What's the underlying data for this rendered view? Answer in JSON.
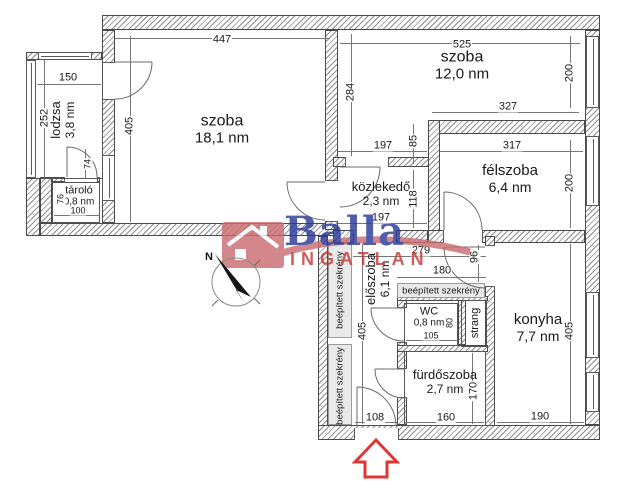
{
  "logo": {
    "brand": "Balla",
    "sub": "INGATLAN"
  },
  "compass": {
    "label": "N"
  },
  "colors": {
    "logo_blue": "#2b3a98",
    "logo_red": "#c13b38",
    "logo_house": "#ca6d71",
    "arrow_red": "#e03535",
    "wall_hatch": "#8f8f8f"
  },
  "rooms": [
    {
      "id": "lodzsa",
      "name": "lodzsa",
      "area": "3,8 nm",
      "x": 63,
      "y": 120,
      "vertical": true,
      "size": 13
    },
    {
      "id": "szoba-1",
      "name": "szoba",
      "area": "18,1 nm",
      "x": 222,
      "y": 130,
      "vertical": false,
      "size": 16
    },
    {
      "id": "szoba-2",
      "name": "szoba",
      "area": "12,0 nm",
      "x": 462,
      "y": 66,
      "vertical": false,
      "size": 16
    },
    {
      "id": "felszoba",
      "name": "félszoba",
      "area": "6,4 nm",
      "x": 510,
      "y": 179,
      "vertical": false,
      "size": 15
    },
    {
      "id": "kozlekedo",
      "name": "közlekedő",
      "area": "2,3 nm",
      "x": 381,
      "y": 194,
      "vertical": false,
      "size": 13
    },
    {
      "id": "tarolo",
      "name": "tároló",
      "area": "0,8 nm",
      "x": 79,
      "y": 196,
      "vertical": false,
      "size": 11
    },
    {
      "id": "eloszoba",
      "name": "előszoba",
      "area": "6,1 nm",
      "x": 378,
      "y": 279,
      "vertical": true,
      "size": 13
    },
    {
      "id": "wc",
      "name": "WC",
      "area": "0,8 nm",
      "x": 429,
      "y": 317,
      "vertical": false,
      "size": 11
    },
    {
      "id": "strang",
      "name": "strang",
      "area": "",
      "x": 475,
      "y": 323,
      "vertical": true,
      "size": 11
    },
    {
      "id": "furdoszoba",
      "name": "fürdőszoba",
      "area": "2,7 nm",
      "x": 445,
      "y": 382,
      "vertical": false,
      "size": 13
    },
    {
      "id": "konyha",
      "name": "konyha",
      "area": "7,7 nm",
      "x": 538,
      "y": 328,
      "vertical": false,
      "size": 15
    }
  ],
  "closets": [
    {
      "id": "szekreny-left-top",
      "label": "beépített szekrény",
      "x": 340,
      "y": 290,
      "vertical": true
    },
    {
      "id": "szekreny-left-bottom",
      "label": "beépített szekrény",
      "x": 340,
      "y": 386,
      "vertical": true
    },
    {
      "id": "szekreny-hall",
      "label": "beépített szekrény",
      "x": 441,
      "y": 291,
      "vertical": false
    }
  ],
  "dims": [
    {
      "value": "447",
      "x": 222,
      "y": 40
    },
    {
      "value": "525",
      "x": 462,
      "y": 45
    },
    {
      "value": "150",
      "x": 68,
      "y": 78
    },
    {
      "value": "252",
      "x": 45,
      "y": 118,
      "v": true
    },
    {
      "value": "405",
      "x": 130,
      "y": 126,
      "v": true
    },
    {
      "value": "284",
      "x": 351,
      "y": 92,
      "v": true
    },
    {
      "value": "200",
      "x": 570,
      "y": 73,
      "v": true
    },
    {
      "value": "327",
      "x": 508,
      "y": 107
    },
    {
      "value": "197",
      "x": 383,
      "y": 146
    },
    {
      "value": "85",
      "x": 414,
      "y": 141,
      "v": true
    },
    {
      "value": "317",
      "x": 512,
      "y": 146
    },
    {
      "value": "200",
      "x": 570,
      "y": 183,
      "v": true
    },
    {
      "value": "118",
      "x": 414,
      "y": 199,
      "v": true
    },
    {
      "value": "197",
      "x": 381,
      "y": 218
    },
    {
      "value": "74",
      "x": 88,
      "y": 164,
      "v": true,
      "s": true
    },
    {
      "value": "76",
      "x": 61,
      "y": 199,
      "v": true,
      "s": true
    },
    {
      "value": "100",
      "x": 78,
      "y": 211,
      "s": true
    },
    {
      "value": "279",
      "x": 421,
      "y": 251
    },
    {
      "value": "96",
      "x": 475,
      "y": 257,
      "v": true
    },
    {
      "value": "180",
      "x": 442,
      "y": 271
    },
    {
      "value": "405",
      "x": 363,
      "y": 331,
      "v": true
    },
    {
      "value": "105",
      "x": 431,
      "y": 336,
      "s": true
    },
    {
      "value": "80",
      "x": 450,
      "y": 323,
      "v": true,
      "s": true
    },
    {
      "value": "170",
      "x": 474,
      "y": 391,
      "v": true
    },
    {
      "value": "108",
      "x": 375,
      "y": 418
    },
    {
      "value": "160",
      "x": 446,
      "y": 418
    },
    {
      "value": "190",
      "x": 540,
      "y": 417
    },
    {
      "value": "405",
      "x": 570,
      "y": 331,
      "v": true
    }
  ]
}
